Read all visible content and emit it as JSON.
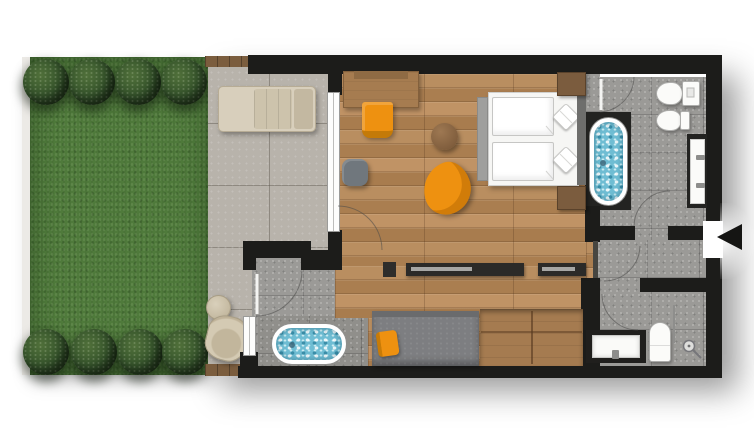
{
  "meta": {
    "title": "Hotel suite floor plan with garden terrace",
    "view": "top-down architectural plan",
    "visible_text": ""
  },
  "palette": {
    "wall": "#1c1c1a",
    "grass": "#4f7a3b",
    "bush": "#33512a",
    "terraceTile": "#b8b3ab",
    "bathTile": "#9b9a97",
    "bathTileDark": "#908f8b",
    "wood": "#b4885a",
    "woodDark": "#a57b50",
    "water": "#6fbdd3",
    "orange": "#ee9110",
    "beige": "#d8cfbc",
    "grey": "#7d7e81",
    "white": "#ffffff"
  },
  "rooms": [
    {
      "id": "garden",
      "label": "Garden lawn with hedges"
    },
    {
      "id": "terrace",
      "label": "Tiled terrace"
    },
    {
      "id": "living-bedroom",
      "label": "Living / bedroom with wood floor"
    },
    {
      "id": "bathroom-main",
      "label": "Main bathroom with bathtub"
    },
    {
      "id": "bathtub-room",
      "label": "Bathtub room with freestanding tub"
    },
    {
      "id": "entrance-hall",
      "label": "Entrance hall"
    },
    {
      "id": "shower-bathroom",
      "label": "Shower bathroom"
    },
    {
      "id": "corridor",
      "label": "Corridor lounge"
    }
  ],
  "items": [
    {
      "id": "sun-lounger",
      "label": "Sun lounger"
    },
    {
      "id": "garden-armchair",
      "label": "Terrace armchair"
    },
    {
      "id": "garden-side-table",
      "label": "Round side table"
    },
    {
      "id": "desk",
      "label": "Desk"
    },
    {
      "id": "desk-chair",
      "label": "Orange desk chair"
    },
    {
      "id": "coffee-table",
      "label": "Round coffee table"
    },
    {
      "id": "ottoman",
      "label": "Grey ottoman"
    },
    {
      "id": "lounge-chair",
      "label": "Orange lounge chair"
    },
    {
      "id": "double-bed",
      "label": "Double bed with two duvets and pillows"
    },
    {
      "id": "bed-bench",
      "label": "Bed-end bench"
    },
    {
      "id": "nightstand-top",
      "label": "Nightstand"
    },
    {
      "id": "nightstand-bottom",
      "label": "Nightstand"
    },
    {
      "id": "built-in-bathtub",
      "label": "Built-in bathtub"
    },
    {
      "id": "freestanding-bathtub",
      "label": "Freestanding bathtub"
    },
    {
      "id": "toilet-main",
      "label": "Wall-hung toilet"
    },
    {
      "id": "bidet",
      "label": "Bidet"
    },
    {
      "id": "double-vanity",
      "label": "Double washbasin vanity"
    },
    {
      "id": "single-vanity",
      "label": "Washbasin vanity"
    },
    {
      "id": "toilet-shower-bath",
      "label": "Toilet"
    },
    {
      "id": "shower",
      "label": "Walk-in shower"
    },
    {
      "id": "daybed",
      "label": "Daybed with orange cushion"
    },
    {
      "id": "media-sideboard",
      "label": "Media sideboard"
    },
    {
      "id": "wardrobe-bench",
      "label": "Wooden wardrobe bench"
    },
    {
      "id": "entrance-marker",
      "label": "Entrance arrow"
    },
    {
      "id": "sliding-door",
      "label": "Terrace sliding glass door"
    },
    {
      "id": "window",
      "label": "Window"
    }
  ]
}
